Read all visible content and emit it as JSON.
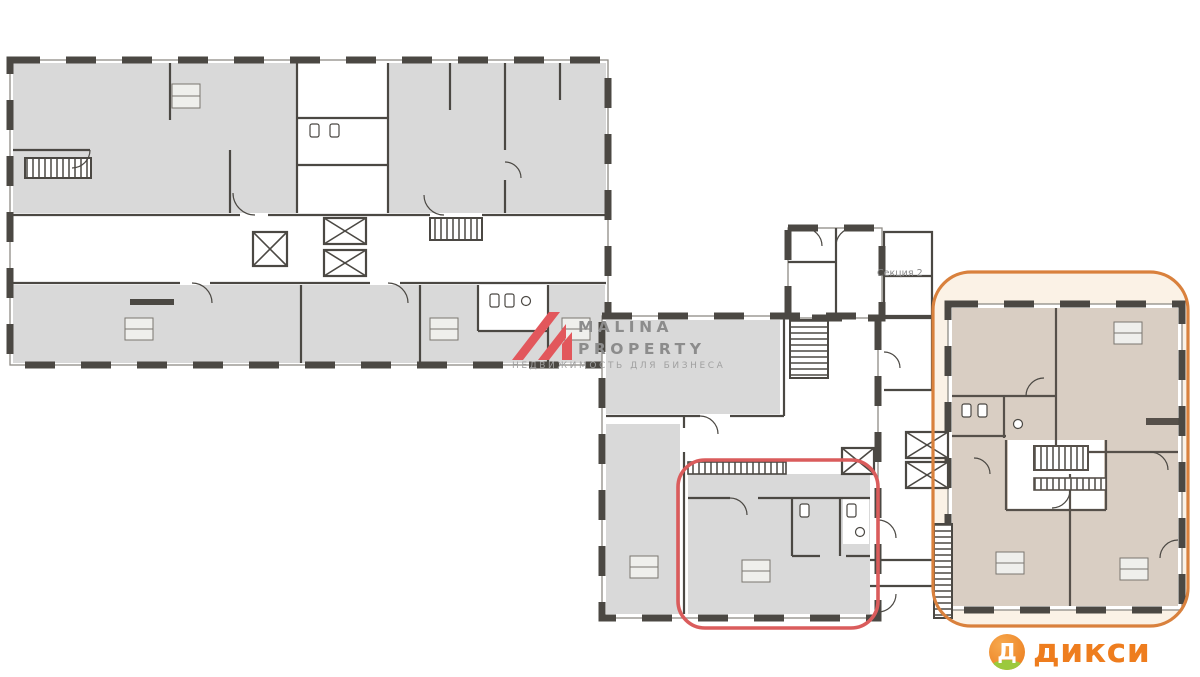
{
  "page": {
    "background_color": "#ffffff"
  },
  "plan": {
    "section_label": "Секция 2",
    "colors": {
      "wall": "#4b4843",
      "room_gray": "#d9d9d9",
      "room_beige": "#d9cec3",
      "orange_zone_background": "#fbf2e6"
    }
  },
  "highlights": {
    "orange": {
      "color": "#d9813d"
    },
    "red": {
      "color": "#da5c5c"
    }
  },
  "watermark": {
    "line1": "MALINA",
    "line2": "PROPERTY",
    "tagline": "НЕДВИЖИМОСТЬ ДЛЯ БИЗНЕСА",
    "logo_color": "#e2575c",
    "text_color": "#8c8c8c"
  },
  "dixy_logo": {
    "letter": "Д",
    "wordmark": "дикси",
    "orange": "#ee7d1e",
    "circle_orange": "#f09030",
    "green": "#9bc93d"
  }
}
